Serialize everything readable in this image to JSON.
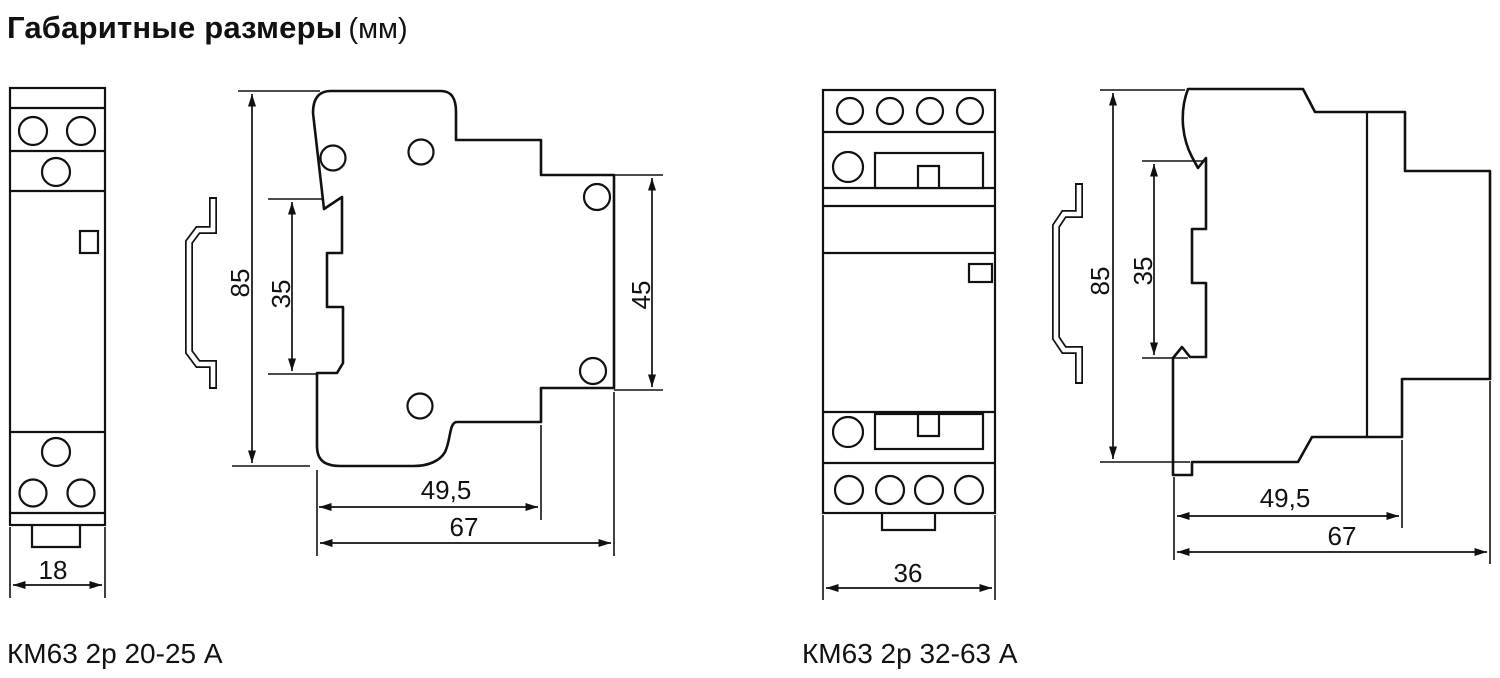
{
  "title": {
    "main": "Габаритные размеры",
    "unit": "(мм)"
  },
  "colors": {
    "ink": "#111111",
    "background": "#ffffff"
  },
  "figures": {
    "left": {
      "label": "КМ63 2р 20-25 А",
      "dims": {
        "width": "18",
        "height": "85",
        "din_rail": "35",
        "side_height": "45",
        "depth_to_step": "49,5",
        "depth_total": "67"
      }
    },
    "right": {
      "label": "КМ63 2р 32-63 А",
      "dims": {
        "width": "36",
        "height": "85",
        "din_rail": "35",
        "depth_to_step": "49,5",
        "depth_total": "67"
      }
    }
  }
}
